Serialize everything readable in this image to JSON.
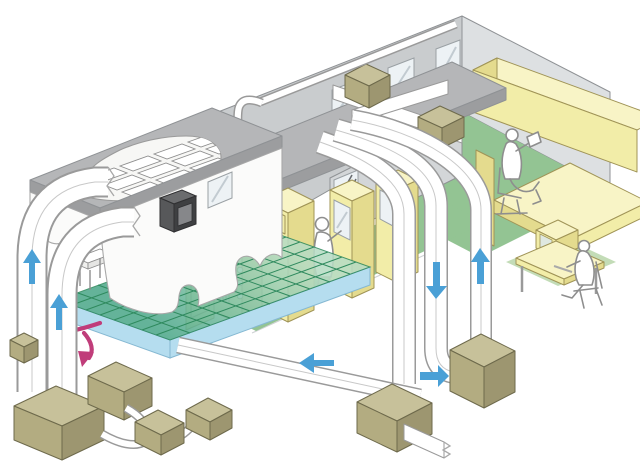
{
  "canvas": {
    "width": 640,
    "height": 467,
    "background": "#ffffff"
  },
  "illustration": {
    "kind": "isometric cutaway diagram",
    "subject": "building air-handling and cleanroom airflow system"
  },
  "colors": {
    "line": "#8f9295",
    "wall_back": "#c9ccce",
    "wall_right": "#dde0e2",
    "wall_inner": "#d3d6d8",
    "roof": "#b5b6b8",
    "roof_edge": "#9c9d9f",
    "floor_green": "#93c493",
    "teal_light": "#b7dcc4",
    "teal_dark": "#4fa98c",
    "grid_line": "#2f8a5e",
    "slab_blue": "#b5ddef",
    "slab_line": "#85b8d2",
    "duct_line": "#9a9a9a",
    "duct_mid": "#c8c8c8",
    "yellow_front": "#f2eda8",
    "yellow_side": "#e4db8e",
    "yellow_top": "#f8f4c6",
    "yellow_line": "#a09457",
    "khaki_top": "#c7c19a",
    "khaki_left": "#b3ac81",
    "khaki_right": "#9d9670",
    "khaki_line": "#6e6a4c",
    "arrow_blue": "#4aa0d6",
    "arrow_pink": "#c03d7a",
    "person": "#8e8e8e",
    "glass": "#edf2f5",
    "glass_line": "#9aa0a4",
    "glass_refl": "#c2cbd1",
    "dark_box": "#57585a",
    "dark_box_side": "#3f4042",
    "dark_box_inner": "#86878a",
    "mat_green": "#b9d6aa",
    "wall_white": "#fbfbfa"
  },
  "airflow_arrows": [
    {
      "name": "riser-duct-1-arrow",
      "direction": "up",
      "color": "blue"
    },
    {
      "name": "riser-duct-2-arrow",
      "direction": "up",
      "color": "blue"
    },
    {
      "name": "return-vertical-arrow",
      "direction": "down",
      "color": "blue"
    },
    {
      "name": "supply-vertical-arrow",
      "direction": "up",
      "color": "blue"
    },
    {
      "name": "to-outdoor-unit-arrow",
      "direction": "right",
      "color": "blue"
    },
    {
      "name": "to-underfloor-plenum-arrow",
      "direction": "left",
      "color": "blue"
    },
    {
      "name": "plenum-circulation-arrow-1",
      "direction": "left",
      "color": "pink"
    },
    {
      "name": "plenum-circulation-arrow-2",
      "direction": "down",
      "color": "pink"
    }
  ],
  "components": {
    "rooms": [
      "cleanroom-with-raised-floor",
      "machine-room",
      "office"
    ],
    "people": [
      "standing-technician",
      "seated-office-worker",
      "operator-at-monitoring-desk"
    ],
    "equipment_boxes_ground": 7,
    "equipment_boxes_roof": 2,
    "ceiling_filter_tiles": 11,
    "windows_clear": 5,
    "windows_hatched": 1,
    "ducts": [
      "left-riser-elbows",
      "roof-cross-duct",
      "descending-duct-bundle",
      "underfloor-return-duct",
      "rooftop-thin-pipe"
    ]
  }
}
